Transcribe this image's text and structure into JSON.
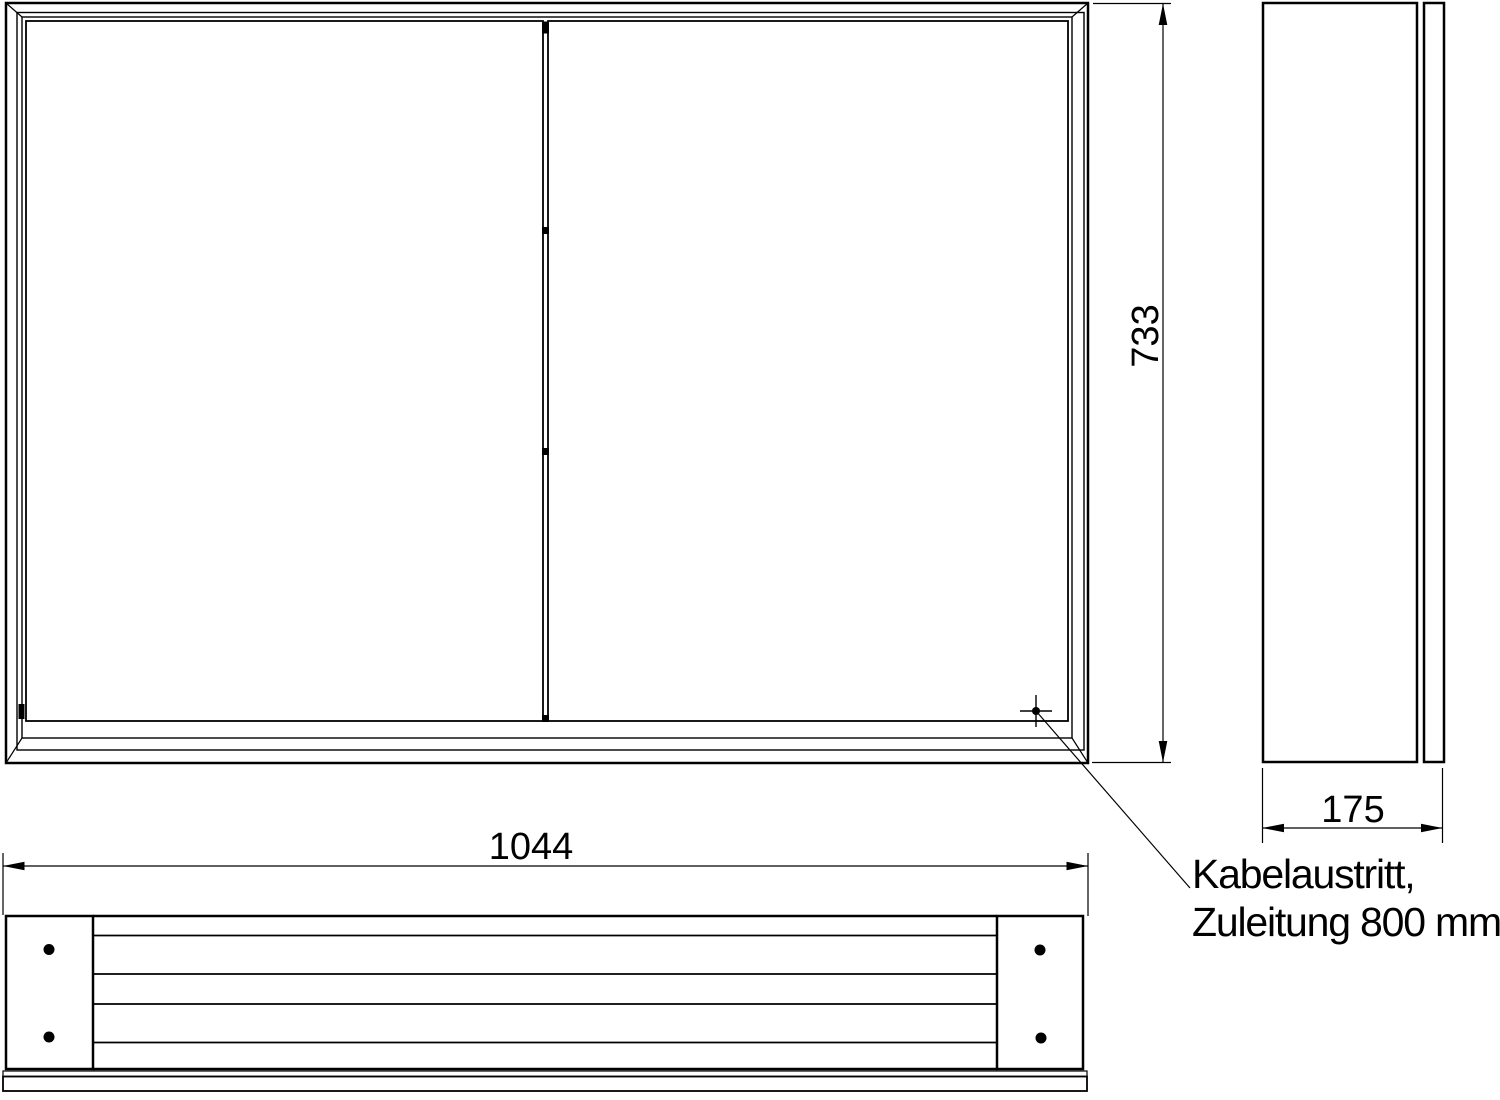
{
  "drawing": {
    "background": "#ffffff",
    "line_color": "#000000",
    "dimensions": {
      "height": "733",
      "width": "1044",
      "depth": "175"
    },
    "cable_note": {
      "line1": "Kabelaustritt,",
      "line2": "Zuleitung 800 mm"
    }
  }
}
